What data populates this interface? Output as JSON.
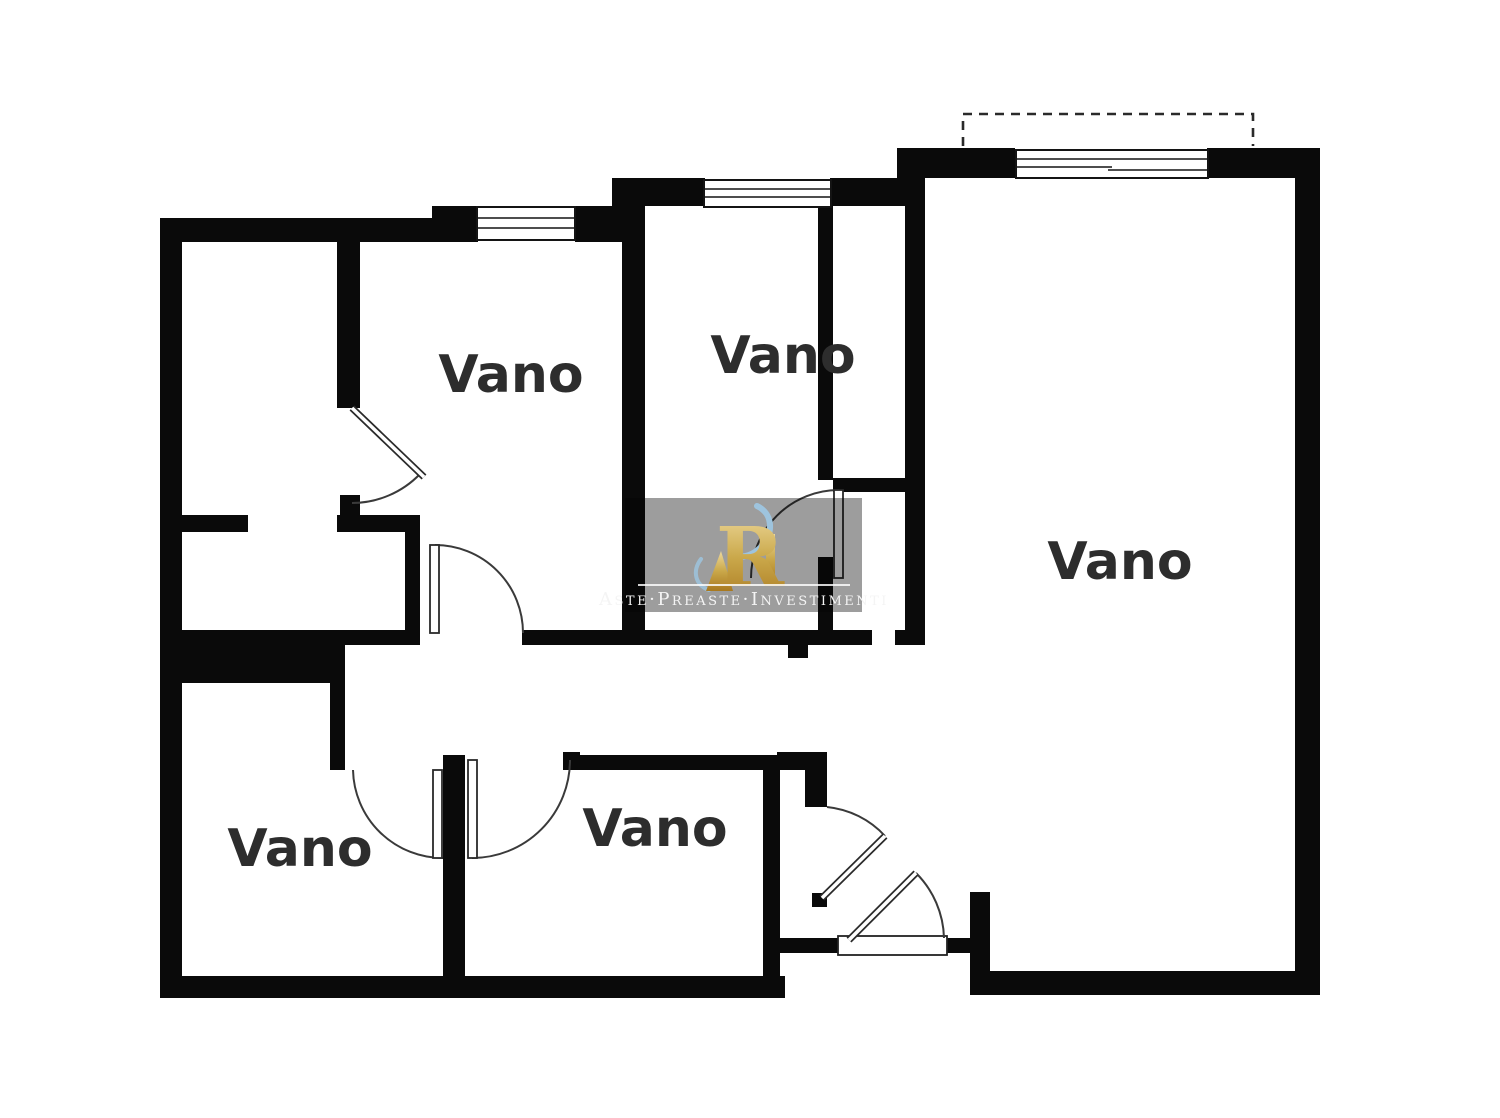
{
  "image_type": "apartment floor plan drawing",
  "rooms": [
    {
      "label": "Vano"
    },
    {
      "label": "Vano"
    },
    {
      "label": "Vano"
    },
    {
      "label": "Vano"
    },
    {
      "label": "Vano"
    }
  ],
  "watermark": {
    "monogram": "R",
    "brand_text": "Aste·Preaste·Investimenti"
  },
  "colors": {
    "wall-color": "#0a0a0a",
    "label-color": "#2d2d2d",
    "watermark-bg": "#989898",
    "gold-light": "#e8d08f",
    "gold-dark": "#b8882f",
    "swoosh-color": "#9ec4de"
  }
}
